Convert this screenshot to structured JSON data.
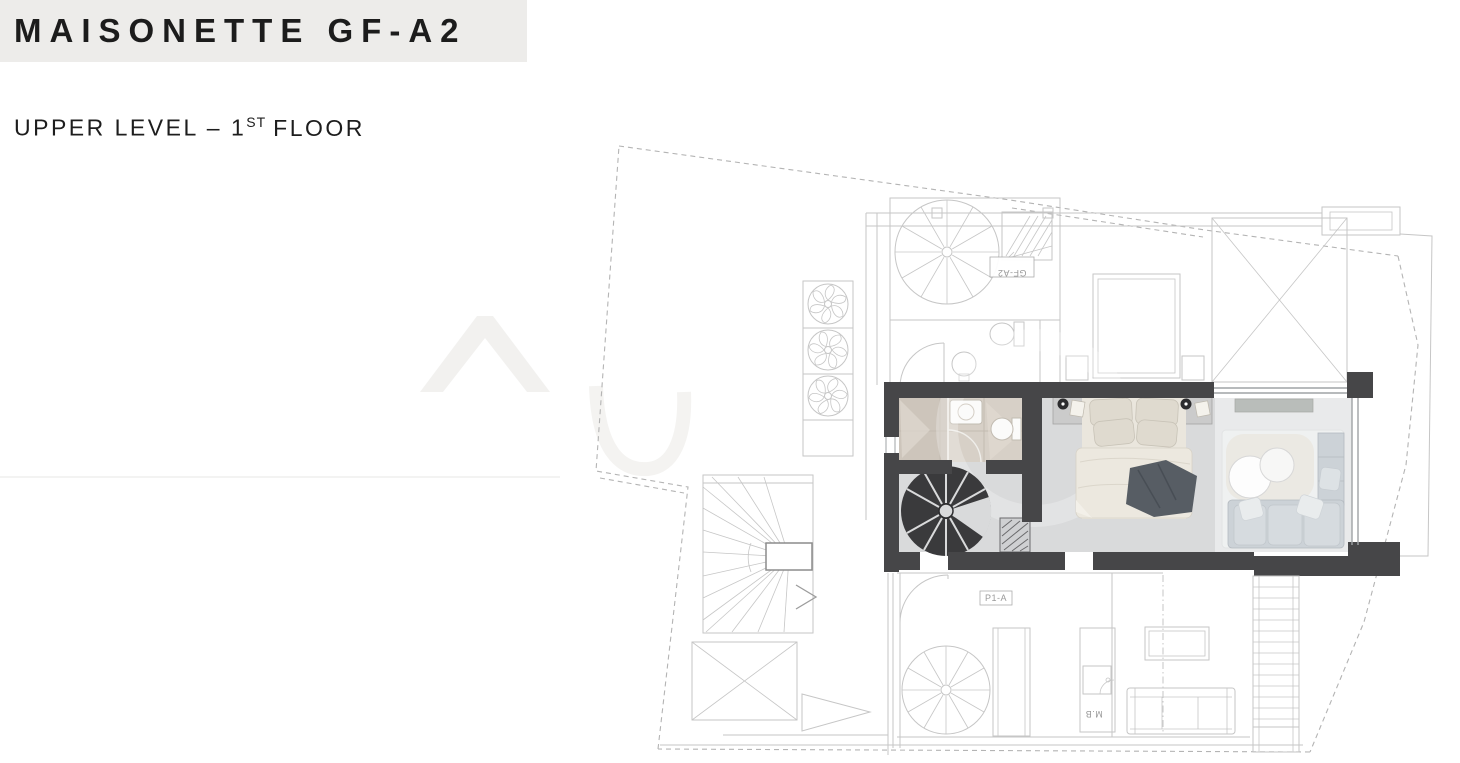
{
  "header": {
    "title": "MAISONETTE GF-A2",
    "subtitle_prefix": "UPPER LEVEL – 1",
    "subtitle_sup": "ST",
    "subtitle_suffix": "FLOOR"
  },
  "plan": {
    "labels": {
      "neighbor_unit_box": "GF-A2",
      "lower_unit_box": "P1-A",
      "kitchen_tag": "M.B"
    },
    "depicted_elements": [
      "plot-boundary-dashed",
      "roof-parapet",
      "ac-units-triple-fan",
      "neighbor-spiral-stair-ghost",
      "stair-hatch-up",
      "guest-wc-ghost",
      "wardrobe-ghost",
      "skylight-void-x",
      "terrace-winder-stair",
      "bathroom-with-shower",
      "dark-spiral-stair",
      "floor-grille",
      "double-bed-with-throw",
      "nightstands-with-lamps",
      "lounge-round-tables",
      "corner-sofa",
      "glazed-facade",
      "lower-level-ghost-plan",
      "straight-stair-down"
    ],
    "colors": {
      "band": "#edecea",
      "ink": "#1c1c1c",
      "wall_dark": "#464648",
      "floor": "#d9dadb",
      "floor_living": "#e9eaeb",
      "tile": "#d7d0c7",
      "tile_dark": "#cdc5bb",
      "ghost_line": "#c6c6c6",
      "dash_line": "#b4b4b4",
      "stair_dark": "#3a3a3c",
      "bed_linen": "#eae6dd",
      "pillow": "#dfdacf",
      "throw_blanket": "#575d64",
      "sofa": "#ccd2d7",
      "label_ink": "#9a9a9a"
    }
  }
}
